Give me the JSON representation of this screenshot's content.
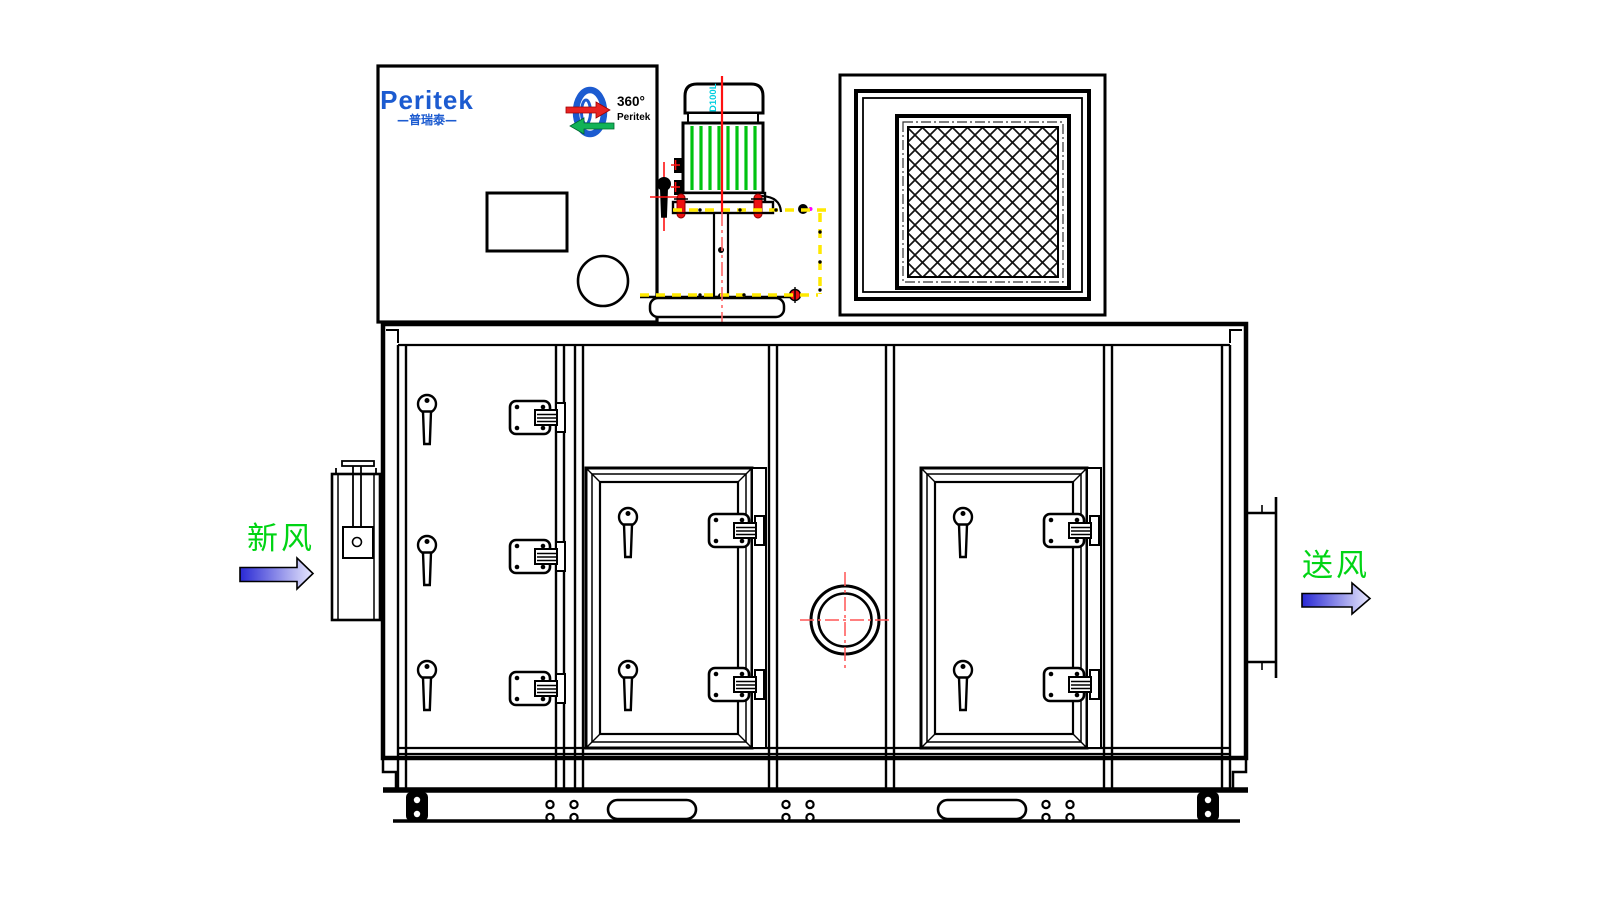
{
  "drawing": {
    "type": "front-elevation technical drawing of a rotary dehumidifier air handling unit"
  },
  "logo": {
    "brand": "Peritek",
    "brand_cn": "—普瑞泰—"
  },
  "rotor_badge": {
    "degree": "360°",
    "brand": "Peritek"
  },
  "motor": {
    "model": "D100L"
  },
  "labels": {
    "fresh_air": "新风",
    "supply_air": "送风"
  },
  "colors": {
    "line": "#000000",
    "logo_blue": "#1c5bd0",
    "stripe_green": "#00c310",
    "text_green": "#00d414",
    "centerline_red": "#ff1111",
    "crosshair_red": "#ff5555",
    "hidden_yellow": "#ffe900",
    "label_cyan": "#00cfe0",
    "magenta_dot": "#ff00ff",
    "arrow_dark": "#2929d4",
    "arrow_light": "#d8d8ff"
  }
}
